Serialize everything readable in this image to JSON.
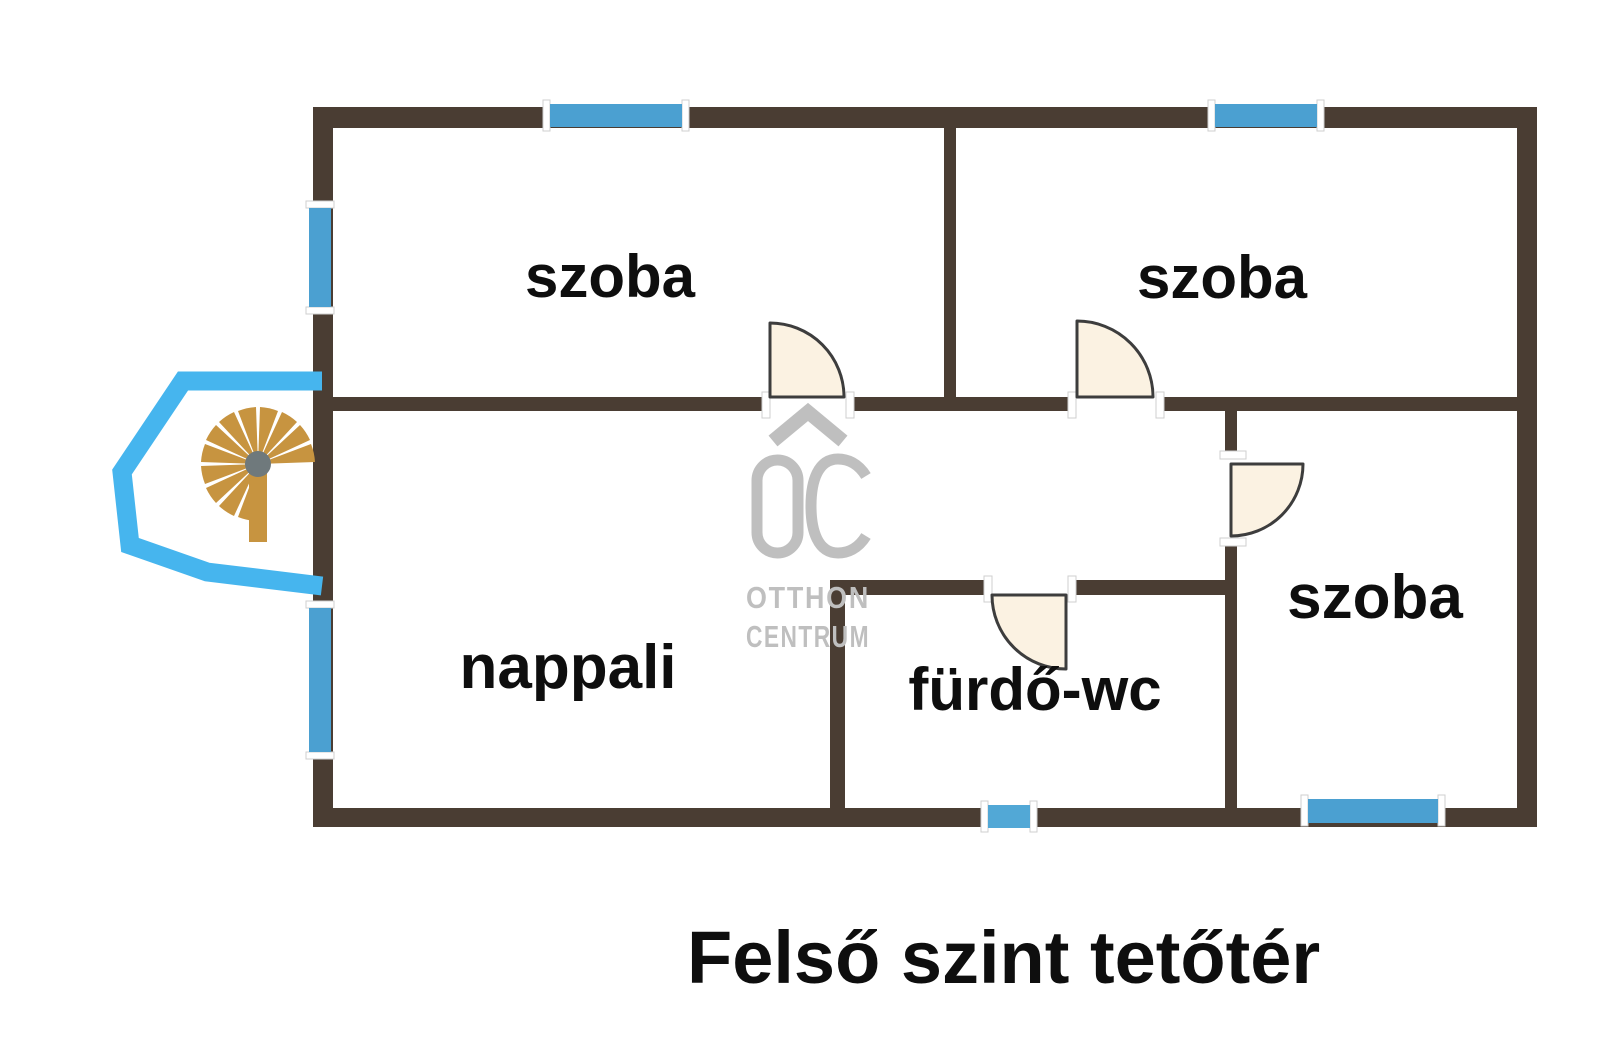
{
  "floor_plan": {
    "title": "Felső szint tetőtér",
    "rooms": [
      {
        "id": "room-top-left",
        "label": "szoba"
      },
      {
        "id": "room-top-right",
        "label": "szoba"
      },
      {
        "id": "living-room",
        "label": "nappali"
      },
      {
        "id": "bathroom-wc",
        "label": "fürdő-wc"
      },
      {
        "id": "room-right",
        "label": "szoba"
      }
    ],
    "watermark": {
      "logo": "OC",
      "line1": "OTTHON",
      "line2": "CENTRUM"
    },
    "symbols": {
      "doors": 4,
      "windows": 6,
      "staircase": "spiral-staircase-icon",
      "bay": "stair-bay-outline"
    },
    "colors": {
      "wall": "#4A3D33",
      "window_blue": "#4BA0D1",
      "bay_blue": "#46B5EE",
      "stair_tan": "#C79440",
      "stair_hub_gray": "#6F797C",
      "door_fill": "#FBF2E2",
      "door_stroke": "#3D3D3D",
      "watermark_gray": "#BFBFBF",
      "label_black": "#0E0E0E"
    }
  }
}
